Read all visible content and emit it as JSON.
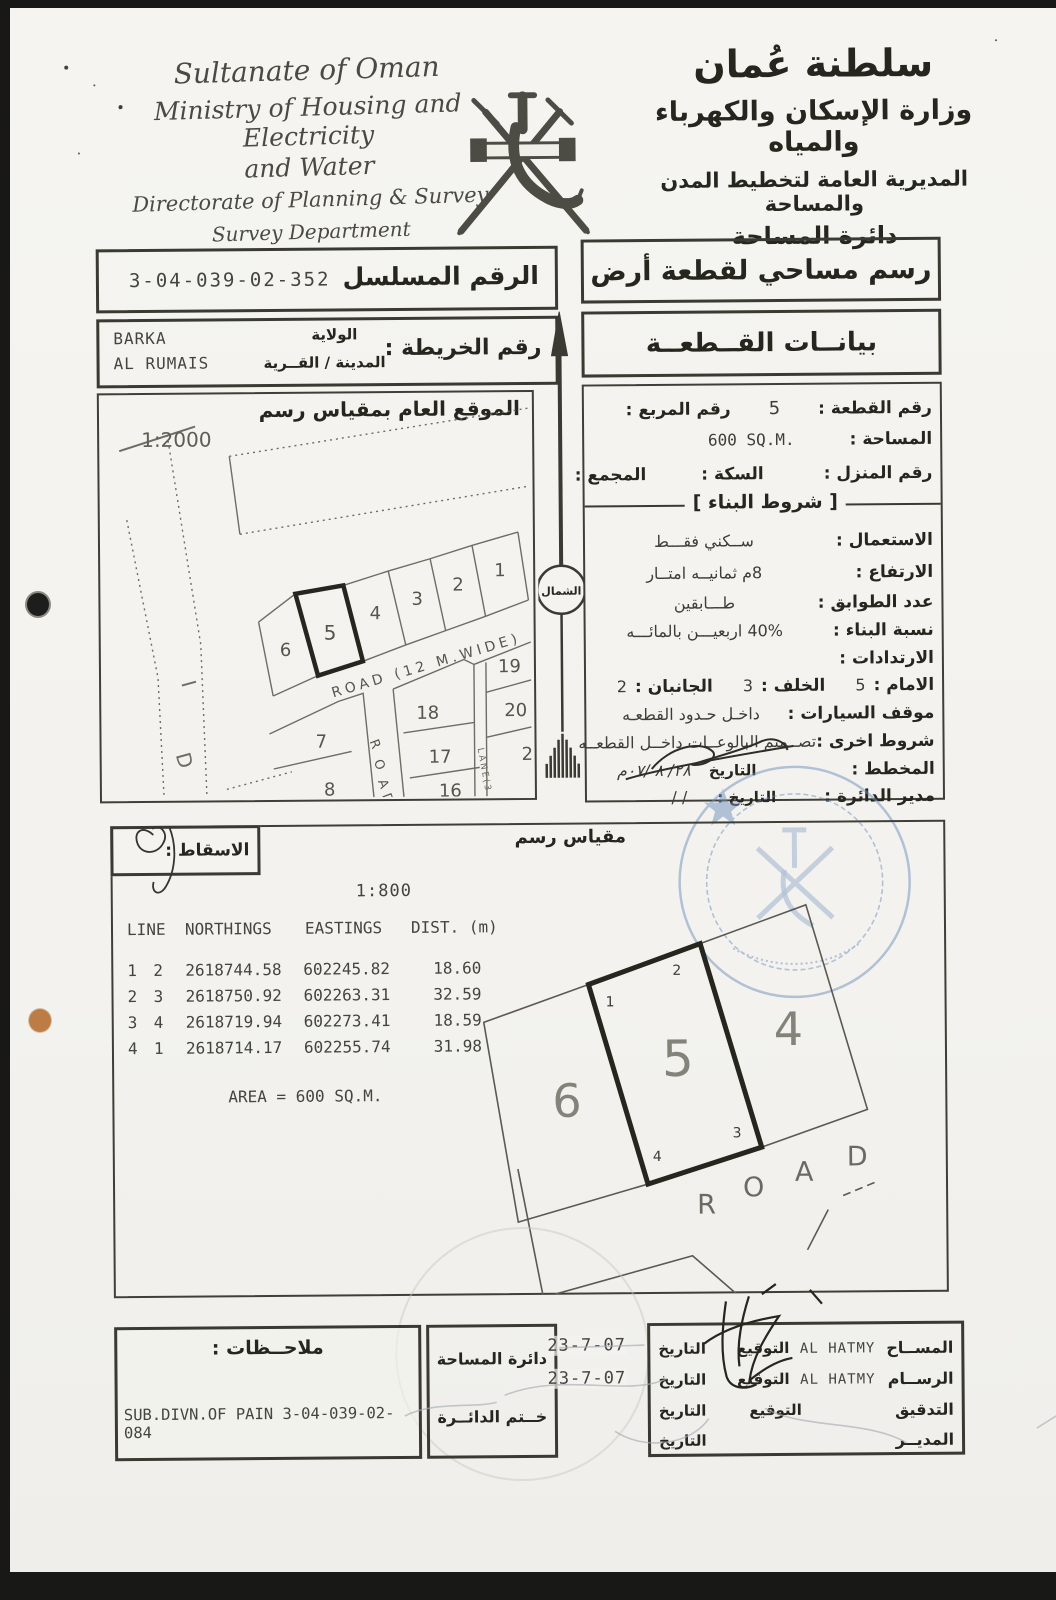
{
  "header": {
    "en": [
      "Sultanate of Oman",
      "Ministry of Housing and Electricity",
      "and Water",
      "Directorate of Planning & Survey",
      "Survey Department"
    ],
    "ar": [
      "سلطنة عُمان",
      "وزارة الإسكان والكهرباء والمياه",
      "المديرية العامة لتخطيط المدن والمساحة",
      "دائرة المساحة"
    ]
  },
  "serial": {
    "label": "الرقم المسلسل",
    "value": "3-04-039-02-352"
  },
  "doc_title": "رسم مساحي لقطعة أرض",
  "map_ref": {
    "label": "رقم الخريطة :",
    "wilaya_label": "الولاية",
    "city_label": "المدينة / القــرية",
    "wilaya": "BARKA",
    "city": "AL RUMAIS"
  },
  "plot_section_title": "بيانــات القــطعــة",
  "location_map": {
    "title": "الموقع العام بمقياس رسم",
    "scale": "1:2000",
    "road_diag": "ROAD (12 M.WIDE)",
    "road_vert": [
      "R",
      "O",
      "A",
      "D"
    ],
    "lane": "LANE(3",
    "wadi": [
      "D",
      "I"
    ],
    "plots_upper": [
      "1",
      "2",
      "3",
      "4",
      "5",
      "6"
    ],
    "plots_lower": [
      "7",
      "8",
      "18",
      "17",
      "16",
      "19",
      "20",
      "2"
    ]
  },
  "north_label": "الشمال",
  "details": {
    "plot_no_label": "رقم القطعة :",
    "plot_no": "5",
    "square_label": "رقم المربع :",
    "area_label": "المساحة :",
    "area": "600  SQ.M.",
    "house_label": "رقم المنزل :",
    "street_label": "السكة :",
    "complex_label": "المجمع :",
    "conditions_title": "[ شروط البناء ]",
    "use_label": "الاستعمال :",
    "use": "ســكني فقـــط",
    "height_label": "الارتفاع :",
    "height": "8م ثمانيــه امتــار",
    "floors_label": "عدد الطوابق :",
    "floors": "طـــابقين",
    "ratio_label": "نسبة البناء :",
    "ratio": "40% اربعيـــن بالمائـــه",
    "setbacks_label": "الارتدادات :",
    "front_label": "الامام :",
    "front": "5",
    "back_label": "الخلف :",
    "back": "3",
    "sides_label": "الجانبان :",
    "sides": "2",
    "parking_label": "موقف السيارات :",
    "parking": "داخـل حـدود القطعـه",
    "other_label": "شروط اخرى :",
    "other": "تصــميم البالوعــات داخــل القطعــه",
    "planner_label": "المخطط :",
    "planner_date_label": "التاريخ",
    "planner_date": "٢٨/ ٨ /٠٧م",
    "manager_label": "مدير الدائرة :",
    "manager_date_label": "التاريخ :",
    "manager_date": "/   /"
  },
  "projection_label": "الاسقاط :",
  "scale_drawing_label": "مقياس رسم",
  "main_scale": "1:800",
  "coords": {
    "headers": [
      "LINE",
      "NORTHINGS",
      "EASTINGS",
      "DIST.  (m)"
    ],
    "rows": [
      [
        "1",
        "2",
        "2618744.58",
        "602245.82",
        "18.60"
      ],
      [
        "2",
        "3",
        "2618750.92",
        "602263.31",
        "32.59"
      ],
      [
        "3",
        "4",
        "2618719.94",
        "602273.41",
        "18.59"
      ],
      [
        "4",
        "1",
        "2618714.17",
        "602255.74",
        "31.98"
      ]
    ],
    "area_line": "AREA  =  600  SQ.M."
  },
  "drawing": {
    "plot_left": "6",
    "plot_center": "5",
    "plot_right": "4",
    "corners": [
      "1",
      "2",
      "3",
      "4"
    ],
    "road_letters": [
      "R",
      "O",
      "A",
      "D"
    ]
  },
  "footer": {
    "notes_label": "ملاحــظات :",
    "notes": "SUB.DIVN.OF  PAIN  3-04-039-02-084",
    "dept_line1": "دائرة المساحة",
    "dept_line2": "خــتم الدائــرة",
    "sig_rows": [
      {
        "role": "المســاح",
        "name": "AL HATMY",
        "sig_label": "التوقيع",
        "date_label": "التاريخ",
        "date": "23-7-07"
      },
      {
        "role": "الرســام",
        "name": "AL HATMY",
        "sig_label": "التوقيع",
        "date_label": "التاريخ",
        "date": "23-7-07"
      },
      {
        "role": "التدقيق",
        "name": "",
        "sig_label": "التوقيع",
        "date_label": "التاريخ",
        "date": ""
      },
      {
        "role": "المديــر",
        "name": "",
        "sig_label": "",
        "date_label": "التاريخ",
        "date": ""
      }
    ]
  }
}
